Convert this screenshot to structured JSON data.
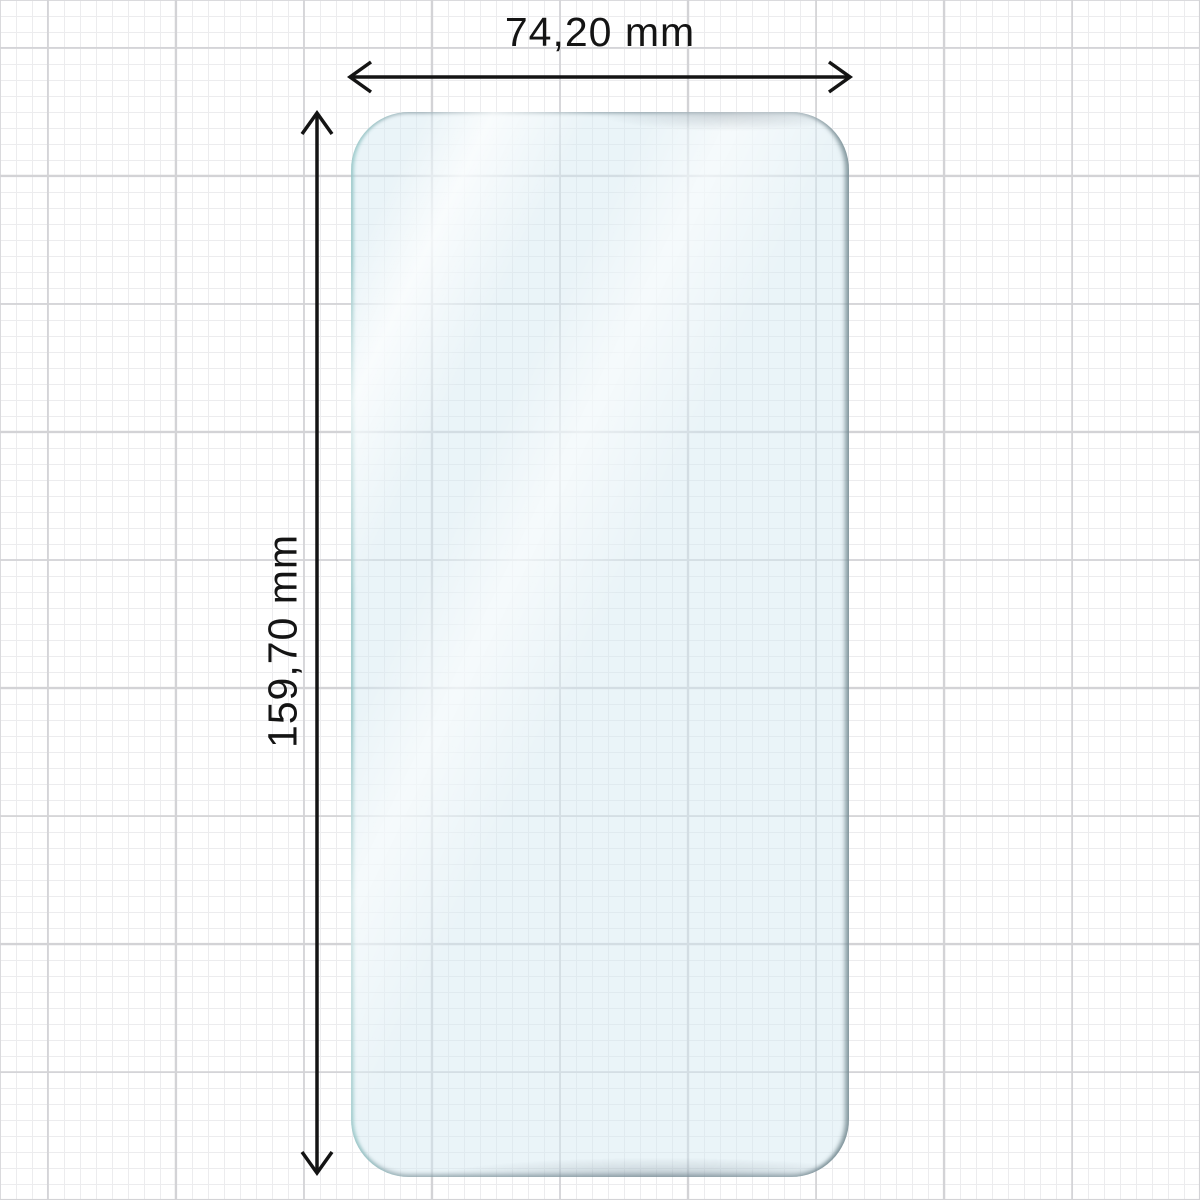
{
  "labels": {
    "width": "74,20 mm",
    "height": "159,70 mm"
  },
  "icons": {
    "width_arrow": "double-headed-arrow-horizontal",
    "height_arrow": "double-headed-arrow-vertical"
  },
  "colors": {
    "arrow": "#141414",
    "text": "#141414",
    "film-fill": "#d3e9f1",
    "film-edge-left": "#aed4d6",
    "film-edge-right": "#83949a",
    "grid-minor": "#ececee",
    "grid-major": "#d3d3d6",
    "background": "#ffffff"
  }
}
